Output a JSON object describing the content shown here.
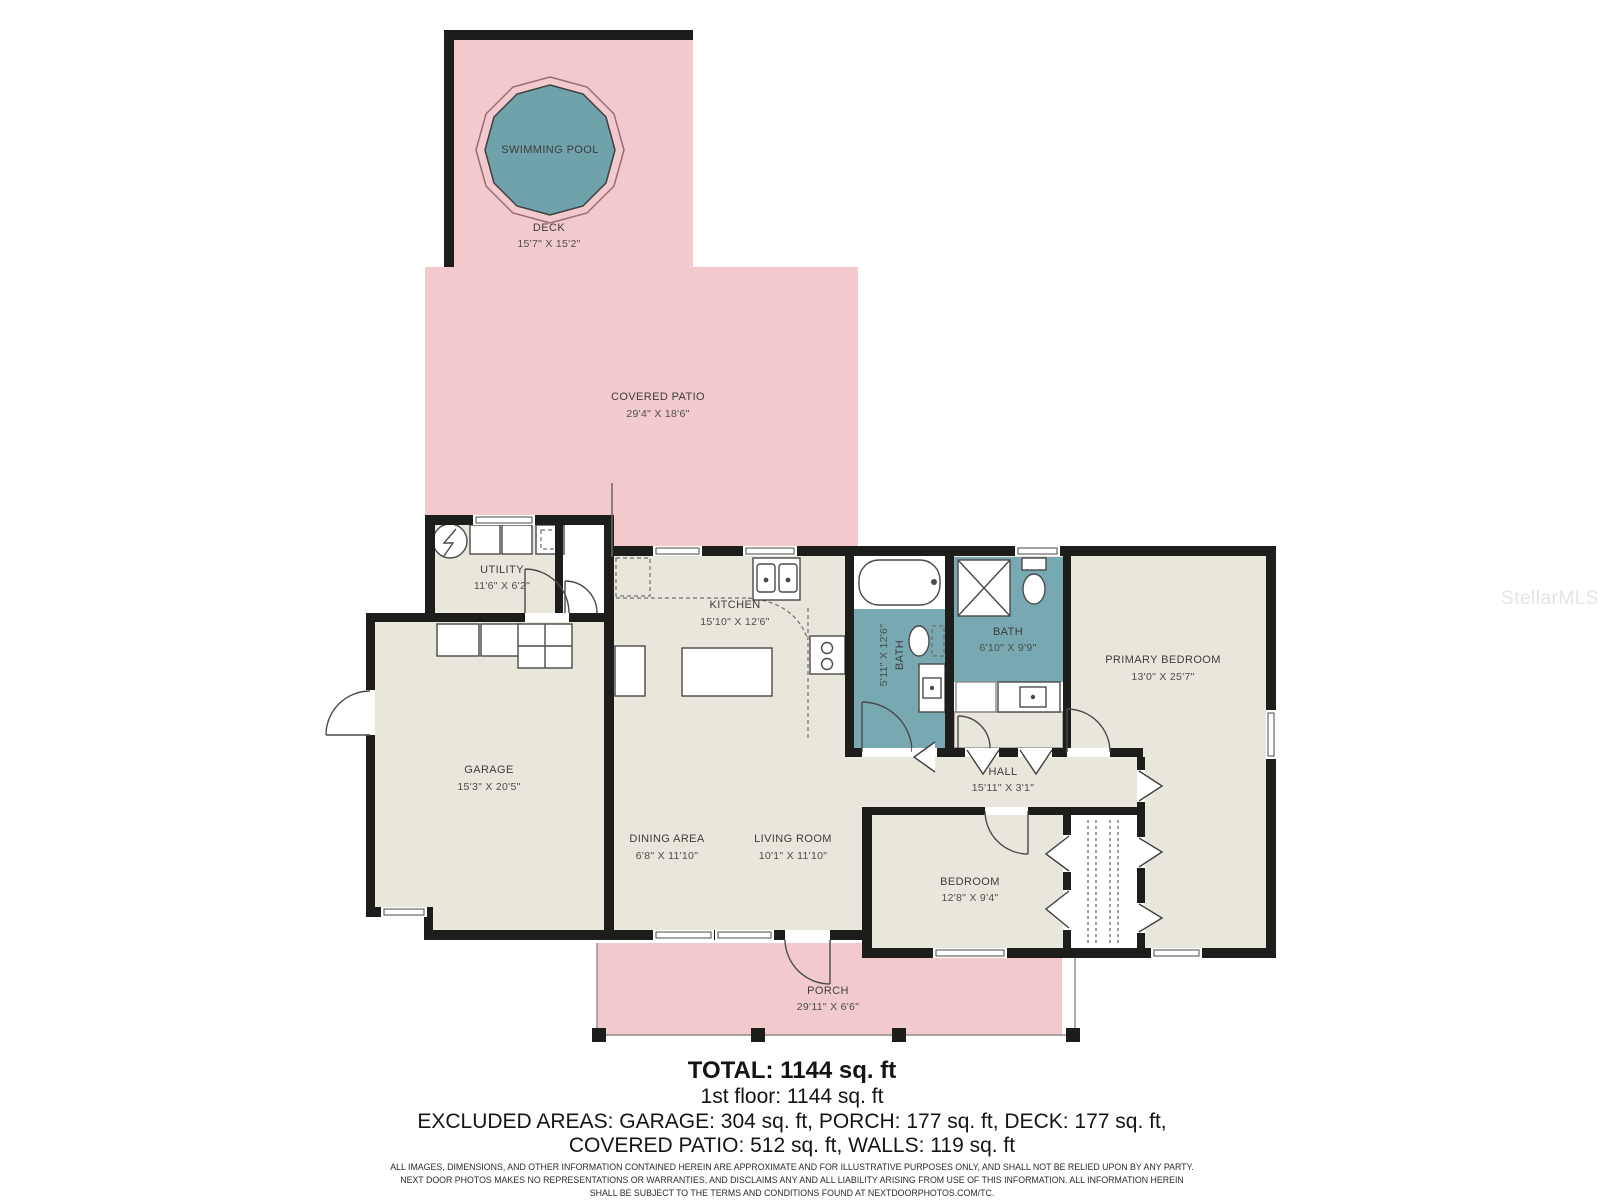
{
  "plan": {
    "watermark": "StellarMLS",
    "rooms": {
      "pool": {
        "label": "SWIMMING POOL"
      },
      "deck": {
        "label": "DECK",
        "dims": "15'7\" X 15'2\""
      },
      "patio": {
        "label": "COVERED PATIO",
        "dims": "29'4\" X 18'6\""
      },
      "utility": {
        "label": "UTILITY",
        "dims": "11'6\" X 6'2\""
      },
      "kitchen": {
        "label": "KITCHEN",
        "dims": "15'10\" X 12'6\""
      },
      "garage": {
        "label": "GARAGE",
        "dims": "15'3\" X 20'5\""
      },
      "bath1": {
        "label": "BATH",
        "dims": "5'11\" X 12'6\""
      },
      "bath2": {
        "label": "BATH",
        "dims": "6'10\" X 9'9\""
      },
      "primary_bedroom": {
        "label": "PRIMARY BEDROOM",
        "dims": "13'0\" X 25'7\""
      },
      "hall": {
        "label": "HALL",
        "dims": "15'11\" X 3'1\""
      },
      "dining": {
        "label": "DINING AREA",
        "dims": "6'8\" X 11'10\""
      },
      "living": {
        "label": "LIVING ROOM",
        "dims": "10'1\" X 11'10\""
      },
      "bedroom": {
        "label": "BEDROOM",
        "dims": "12'8\" X 9'4\""
      },
      "porch": {
        "label": "PORCH",
        "dims": "29'11\" X 6'6\""
      }
    },
    "summary": {
      "total": "TOTAL: 1144 sq. ft",
      "floor1": "1st floor: 1144 sq. ft",
      "excluded1": "EXCLUDED AREAS: GARAGE: 304 sq. ft, PORCH: 177 sq. ft, DECK: 177 sq. ft,",
      "excluded2": "COVERED PATIO: 512 sq. ft, WALLS: 119 sq. ft"
    },
    "disclaimer": {
      "line1": "ALL IMAGES, DIMENSIONS, AND OTHER INFORMATION CONTAINED HEREIN ARE APPROXIMATE AND FOR ILLUSTRATIVE PURPOSES ONLY, AND SHALL NOT BE RELIED UPON BY ANY PARTY.",
      "line2": "NEXT DOOR PHOTOS MAKES NO REPRESENTATIONS OR WARRANTIES, AND DISCLAIMS ANY AND ALL LIABILITY ARISING FROM USE OF THIS INFORMATION. ALL INFORMATION HEREIN",
      "line3": "SHALL BE SUBJECT TO THE TERMS AND CONDITIONS FOUND AT NEXTDOORPHOTOS.COM/TC."
    },
    "colors": {
      "outdoor_pink": "#f2cacd",
      "pool_teal": "#6fa2ab",
      "bath_teal": "#78a8b1",
      "floor_beige": "#e9e7db",
      "wall_black": "#1d1d1b"
    }
  }
}
